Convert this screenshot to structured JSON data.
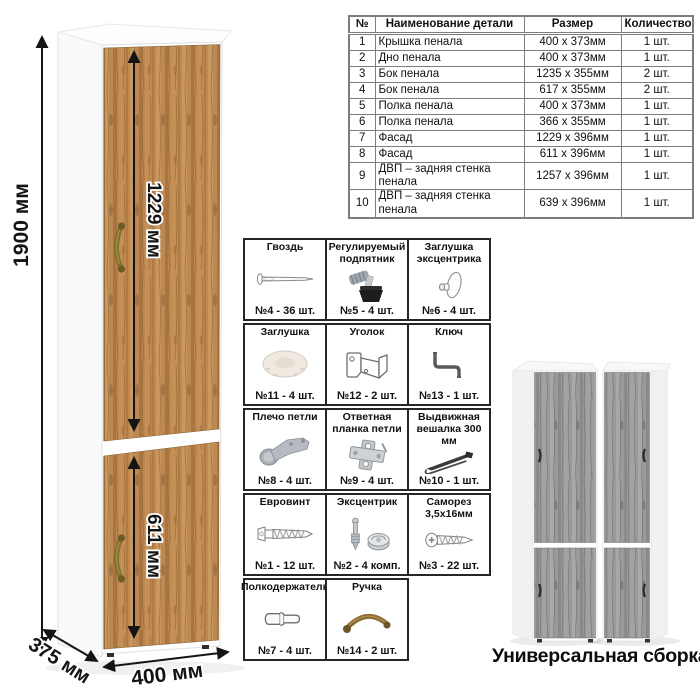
{
  "colors": {
    "oak_wood": "#bd8851",
    "gray_wood": "#9a9a9a",
    "bronze_handle": "#8a6a33",
    "table_border": "#7d7d7d",
    "grid_border": "#262626"
  },
  "dimensions": {
    "total_height": "1900 мм",
    "upper_door_height": "1229 мм",
    "lower_door_height": "611 мм",
    "depth": "375 мм",
    "width": "400 мм"
  },
  "parts_table": {
    "headers": [
      "№",
      "Наименование детали",
      "Размер",
      "Количество"
    ],
    "rows": [
      [
        "1",
        "Крышка пенала",
        "400 x 373мм",
        "1 шт."
      ],
      [
        "2",
        "Дно пенала",
        "400 x 373мм",
        "1 шт."
      ],
      [
        "3",
        "Бок пенала",
        "1235 x 355мм",
        "2 шт."
      ],
      [
        "4",
        "Бок пенала",
        "617 x 355мм",
        "2 шт."
      ],
      [
        "5",
        "Полка пенала",
        "400 x 373мм",
        "1 шт."
      ],
      [
        "6",
        "Полка пенала",
        "366 x 355мм",
        "1 шт."
      ],
      [
        "7",
        "Фасад",
        "1229 x 396мм",
        "1 шт."
      ],
      [
        "8",
        "Фасад",
        "611 x 396мм",
        "1 шт."
      ],
      [
        "9",
        "ДВП – задняя стенка пенала",
        "1257 x 396мм",
        "1 шт."
      ],
      [
        "10",
        "ДВП – задняя стенка пенала",
        "639 x 396мм",
        "1 шт."
      ]
    ]
  },
  "hardware": {
    "rows": [
      {
        "items": [
          {
            "title": "Гвоздь",
            "count": "№4 - 36 шт."
          },
          {
            "title": "Регулируемый подпятник",
            "count": "№5 - 4 шт."
          },
          {
            "title": "Заглушка эксцентрика",
            "count": "№6 - 4 шт."
          }
        ]
      },
      {
        "items": [
          {
            "title": "Заглушка",
            "count": "№11 - 4 шт."
          },
          {
            "title": "Уголок",
            "count": "№12 - 2 шт."
          },
          {
            "title": "Ключ",
            "count": "№13 - 1 шт."
          }
        ]
      },
      {
        "items": [
          {
            "title": "Плечо петли",
            "count": "№8 - 4 шт."
          },
          {
            "title": "Ответная планка петли",
            "count": "№9 - 4 шт."
          },
          {
            "title": "Выдвижная вешалка 300 мм",
            "count": "№10 - 1 шт."
          }
        ]
      },
      {
        "items": [
          {
            "title": "Евровинт",
            "count": "№1 - 12 шт."
          },
          {
            "title": "Эксцентрик",
            "count": "№2 - 4 комп."
          },
          {
            "title": "Саморез 3,5х16мм",
            "count": "№3 - 22 шт."
          }
        ]
      },
      {
        "items": [
          {
            "title": "Полкодержатель",
            "count": "№7 - 4 шт."
          },
          {
            "title": "Ручка",
            "count": "№14 - 2 шт."
          }
        ]
      }
    ]
  },
  "footer": {
    "caption": "Универсальная сборка."
  }
}
